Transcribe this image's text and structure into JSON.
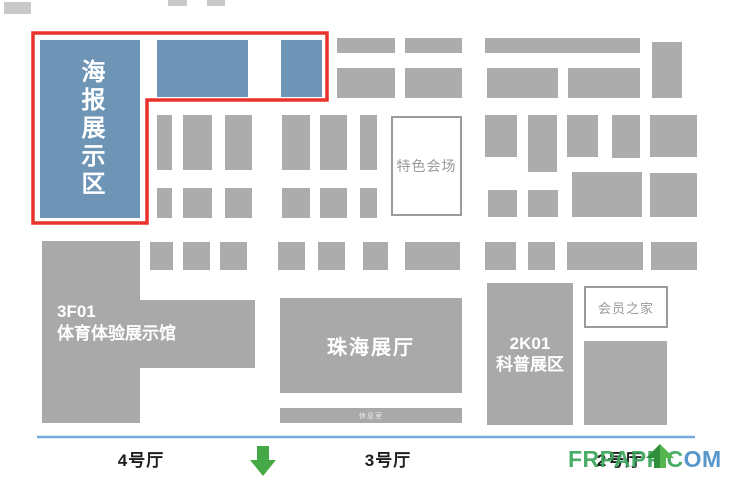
{
  "colors": {
    "poster-blue": "#6e94b6",
    "booth-gray": "#acacac",
    "building-gray": "#a9a9a9",
    "faint-gray": "#c9c9c9",
    "highlight-red": "#e8322b",
    "baseline-blue": "#73a9dc",
    "arrow-green": "#45a946",
    "arrow-green-dark": "#2f8f3b",
    "arrow-green-light": "#55b54f",
    "box-border": "#9b9b9b",
    "box-text": "#9a9a9a",
    "wm-green": "#3aa55b",
    "wm-blue": "#4a8fc7"
  },
  "poster_area": {
    "label": "海报展示区"
  },
  "special_venue": {
    "label": "特色会场"
  },
  "sports_hall": {
    "code": "3F01",
    "name": "体育体验展示馆"
  },
  "zhuhai_hall": {
    "label": "珠海展厅"
  },
  "rest_room": {
    "label": "休息室"
  },
  "science_zone": {
    "code": "2K01",
    "name": "科普展区"
  },
  "members_home": {
    "label": "会员之家"
  },
  "halls": [
    {
      "label": "4号厅"
    },
    {
      "label": "3号厅"
    },
    {
      "label": "2号厅"
    }
  ],
  "watermark": {
    "green_part": "FRPAPP.C",
    "blue_part": "OM"
  },
  "icons": [
    "down-arrow-icon",
    "up-arrow-icon"
  ],
  "booths": [
    {
      "x": 157,
      "y": 40,
      "w": 91,
      "h": 57,
      "t": "blue"
    },
    {
      "x": 281,
      "y": 40,
      "w": 41,
      "h": 57,
      "t": "blue"
    },
    {
      "x": 4,
      "y": 2,
      "w": 27,
      "h": 12,
      "t": "faint"
    },
    {
      "x": 168,
      "y": 0,
      "w": 19,
      "h": 6,
      "t": "faint"
    },
    {
      "x": 207,
      "y": 0,
      "w": 18,
      "h": 6,
      "t": "faint"
    },
    {
      "x": 337,
      "y": 38,
      "w": 58,
      "h": 15
    },
    {
      "x": 405,
      "y": 38,
      "w": 57,
      "h": 15
    },
    {
      "x": 485,
      "y": 38,
      "w": 155,
      "h": 15
    },
    {
      "x": 652,
      "y": 42,
      "w": 30,
      "h": 56
    },
    {
      "x": 337,
      "y": 68,
      "w": 58,
      "h": 30
    },
    {
      "x": 405,
      "y": 68,
      "w": 57,
      "h": 30
    },
    {
      "x": 487,
      "y": 68,
      "w": 71,
      "h": 30
    },
    {
      "x": 568,
      "y": 68,
      "w": 72,
      "h": 30
    },
    {
      "x": 157,
      "y": 115,
      "w": 15,
      "h": 55
    },
    {
      "x": 183,
      "y": 115,
      "w": 29,
      "h": 55
    },
    {
      "x": 225,
      "y": 115,
      "w": 27,
      "h": 55
    },
    {
      "x": 282,
      "y": 115,
      "w": 28,
      "h": 55
    },
    {
      "x": 320,
      "y": 115,
      "w": 27,
      "h": 55
    },
    {
      "x": 360,
      "y": 115,
      "w": 17,
      "h": 55
    },
    {
      "x": 157,
      "y": 188,
      "w": 15,
      "h": 30
    },
    {
      "x": 183,
      "y": 188,
      "w": 29,
      "h": 30
    },
    {
      "x": 225,
      "y": 188,
      "w": 27,
      "h": 30
    },
    {
      "x": 282,
      "y": 188,
      "w": 28,
      "h": 30
    },
    {
      "x": 320,
      "y": 188,
      "w": 27,
      "h": 30
    },
    {
      "x": 360,
      "y": 188,
      "w": 17,
      "h": 30
    },
    {
      "x": 150,
      "y": 242,
      "w": 23,
      "h": 28
    },
    {
      "x": 183,
      "y": 242,
      "w": 27,
      "h": 28
    },
    {
      "x": 220,
      "y": 242,
      "w": 27,
      "h": 28
    },
    {
      "x": 278,
      "y": 242,
      "w": 27,
      "h": 28
    },
    {
      "x": 318,
      "y": 242,
      "w": 27,
      "h": 28
    },
    {
      "x": 363,
      "y": 242,
      "w": 25,
      "h": 28
    },
    {
      "x": 405,
      "y": 242,
      "w": 55,
      "h": 28
    },
    {
      "x": 485,
      "y": 115,
      "w": 32,
      "h": 42
    },
    {
      "x": 528,
      "y": 115,
      "w": 29,
      "h": 57
    },
    {
      "x": 567,
      "y": 115,
      "w": 31,
      "h": 42
    },
    {
      "x": 612,
      "y": 115,
      "w": 28,
      "h": 43
    },
    {
      "x": 650,
      "y": 115,
      "w": 47,
      "h": 42
    },
    {
      "x": 488,
      "y": 190,
      "w": 29,
      "h": 27
    },
    {
      "x": 528,
      "y": 190,
      "w": 30,
      "h": 27
    },
    {
      "x": 572,
      "y": 172,
      "w": 70,
      "h": 45
    },
    {
      "x": 650,
      "y": 173,
      "w": 47,
      "h": 44
    },
    {
      "x": 485,
      "y": 242,
      "w": 31,
      "h": 28
    },
    {
      "x": 528,
      "y": 242,
      "w": 27,
      "h": 28
    },
    {
      "x": 567,
      "y": 242,
      "w": 76,
      "h": 28
    },
    {
      "x": 651,
      "y": 242,
      "w": 46,
      "h": 28
    },
    {
      "x": 584,
      "y": 341,
      "w": 83,
      "h": 84
    }
  ],
  "highlight_outline_points": "33,33 327,33 327,100 147,100 147,223 33,223",
  "baseline": {
    "x1": 37,
    "y1": 437,
    "x2": 695,
    "y2": 437
  }
}
